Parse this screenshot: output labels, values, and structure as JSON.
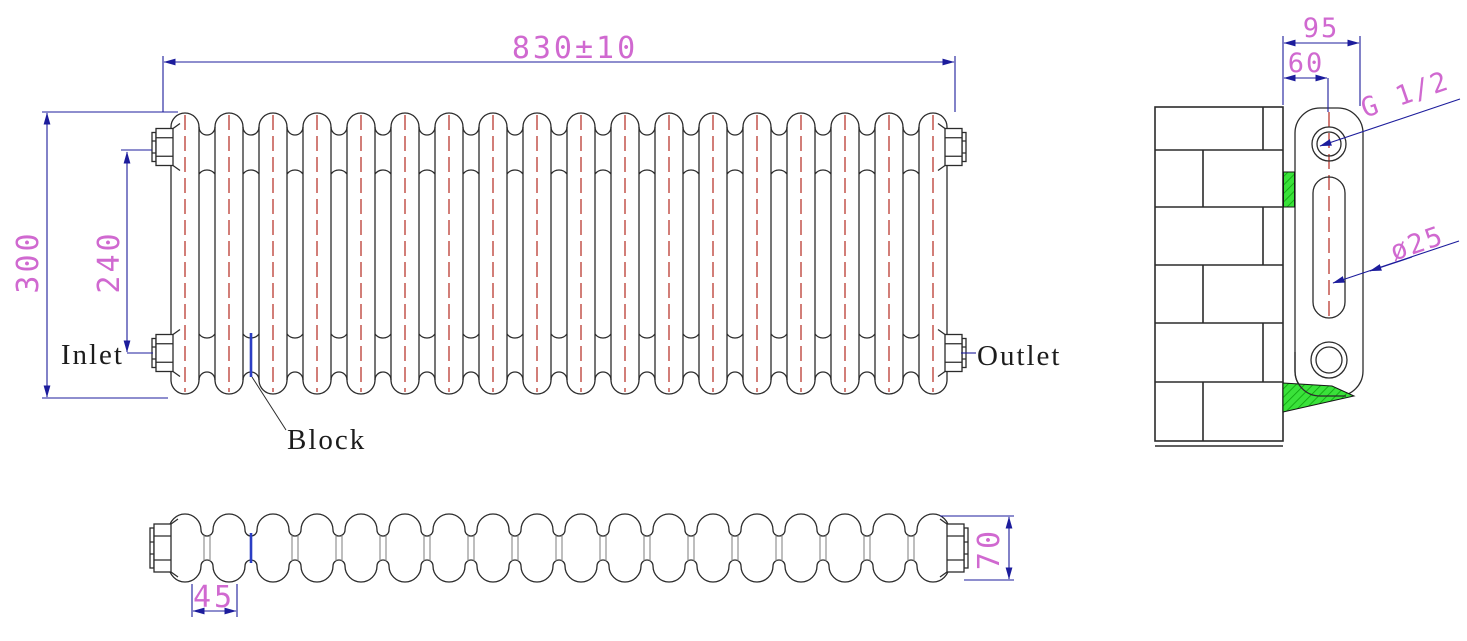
{
  "front_view": {
    "overall_width": "830±10",
    "overall_height": "300",
    "connection_spacing": "240",
    "inlet_label": "Inlet",
    "outlet_label": "Outlet",
    "block_label": "Block",
    "column_count": 18
  },
  "top_view": {
    "section_pitch": "45",
    "depth": "70"
  },
  "side_view": {
    "overall_depth": "95",
    "wall_to_axis": "60",
    "thread_size": "G 1/2",
    "column_diameter": "ø25"
  },
  "colors": {
    "dimension_line": "#1c1c9c",
    "dimension_text": "#d069d0",
    "outline": "#2b2b2b",
    "centerline_red": "#b4281e",
    "bracket_green": "#3ae23a",
    "block_highlight_blue": "#2b3ec4"
  }
}
